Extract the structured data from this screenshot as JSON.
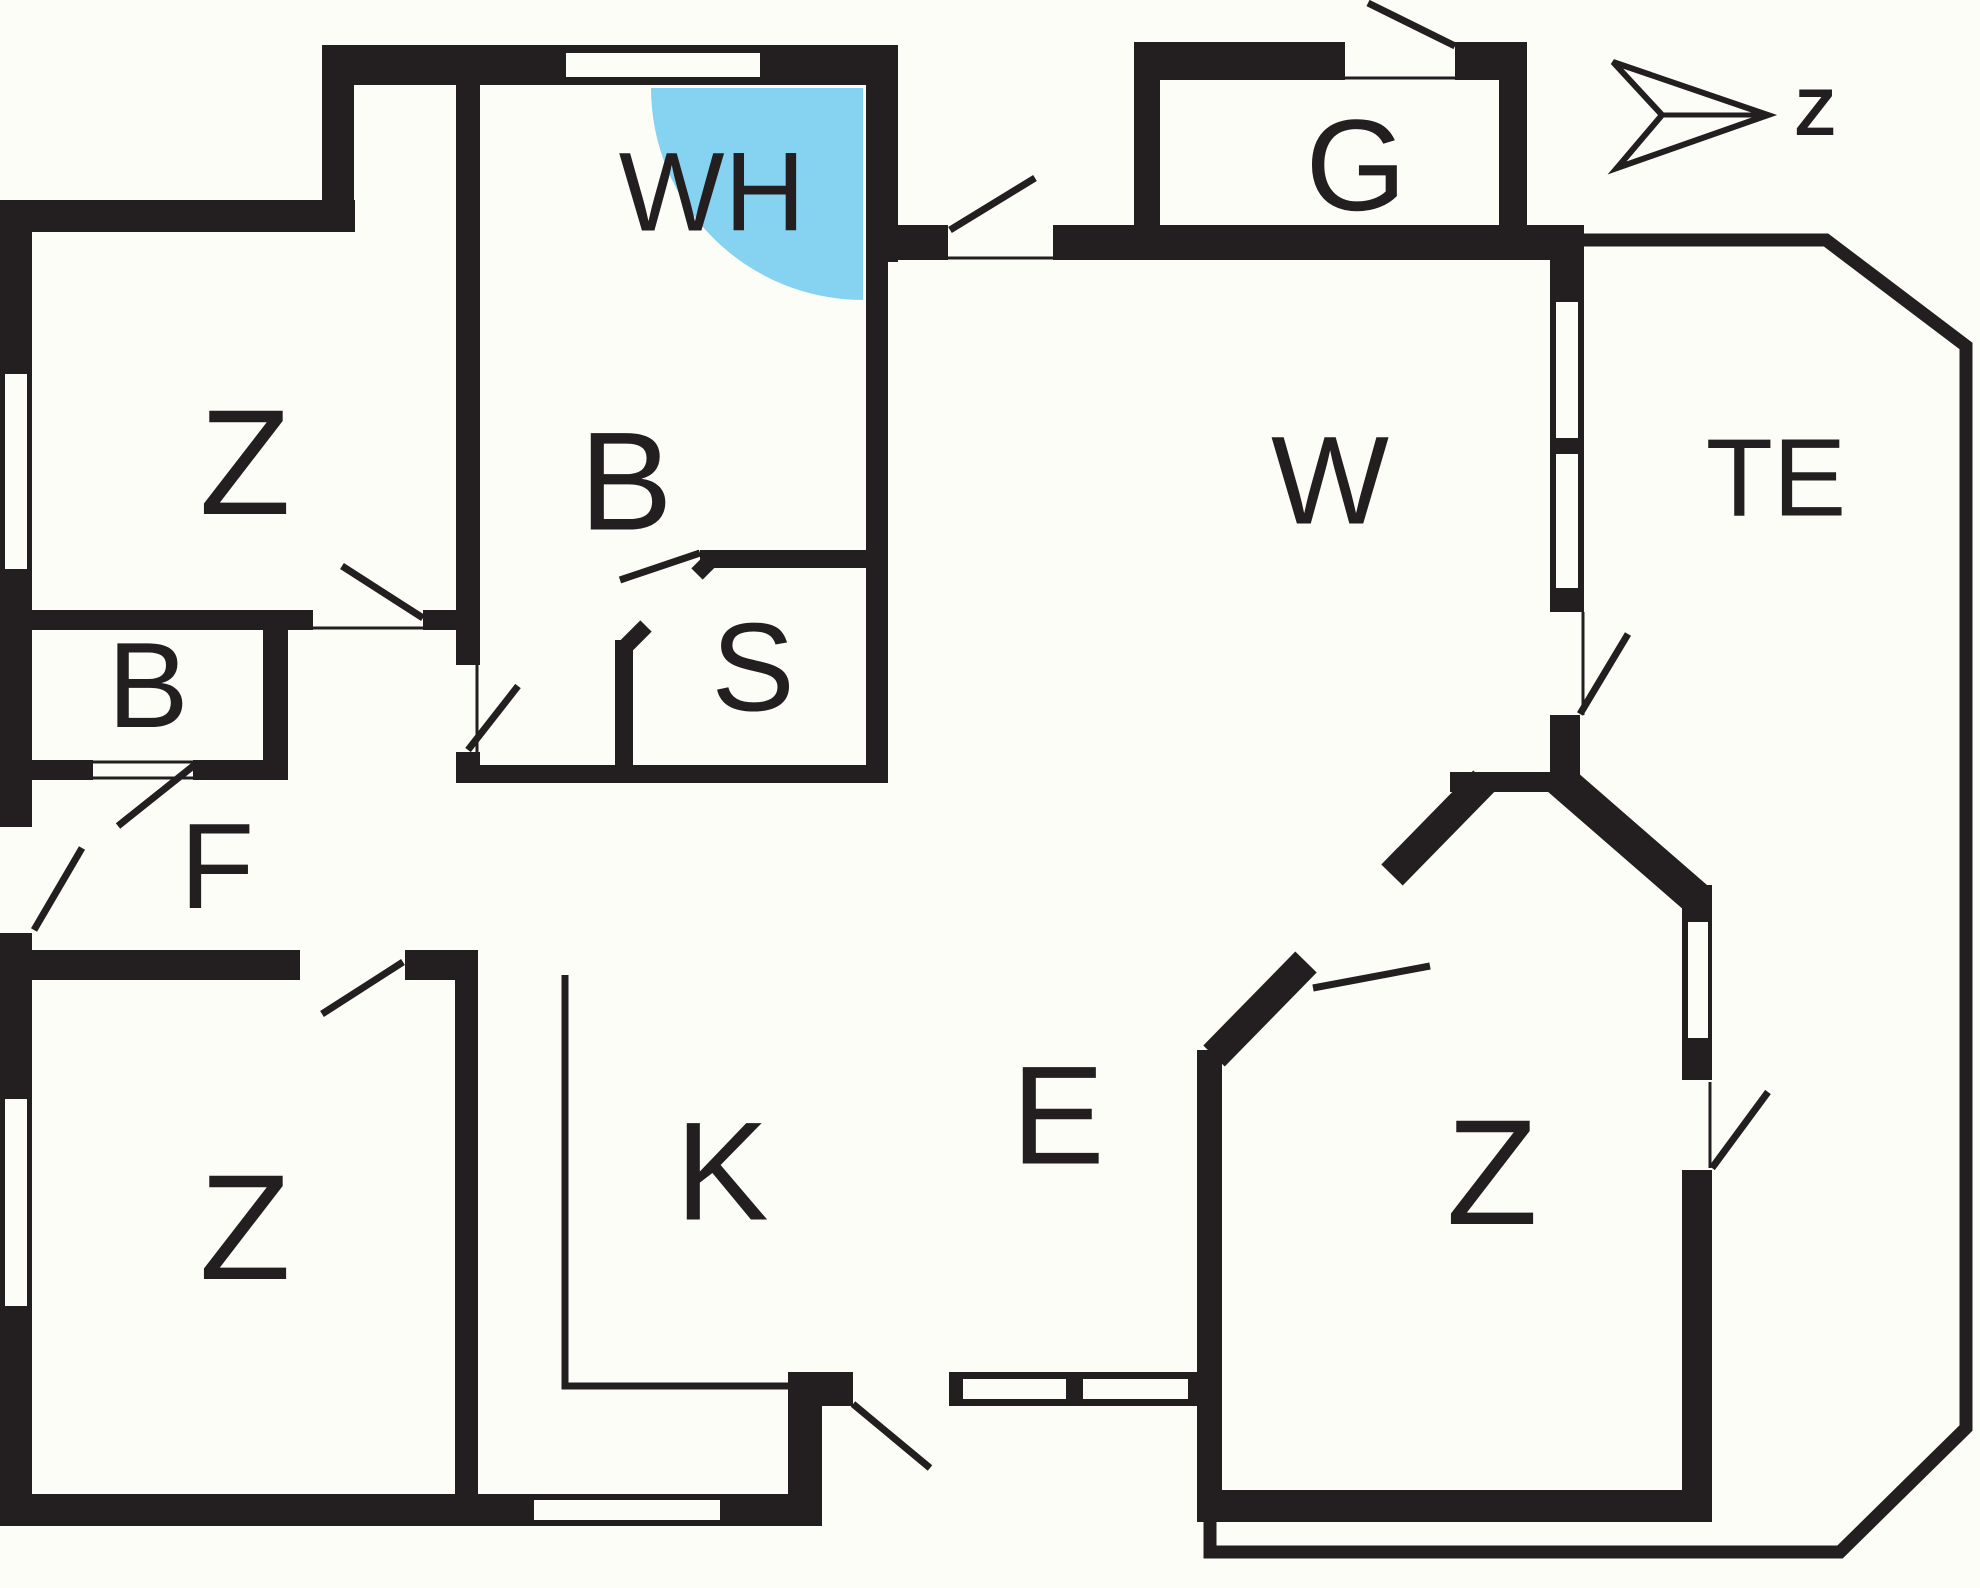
{
  "colors": {
    "wall": "#231F20",
    "paper": "#FDFDF7",
    "shower": "#85D3F0"
  },
  "rooms": [
    {
      "id": "bedroom-northwest",
      "label": "Z"
    },
    {
      "id": "bathroom",
      "label": "B"
    },
    {
      "id": "shower-corner",
      "label": "WH"
    },
    {
      "id": "sauna",
      "label": "S"
    },
    {
      "id": "wc",
      "label": "B"
    },
    {
      "id": "hallway",
      "label": "F"
    },
    {
      "id": "bedroom-southwest",
      "label": "Z"
    },
    {
      "id": "kitchen",
      "label": "K"
    },
    {
      "id": "dining",
      "label": "E"
    },
    {
      "id": "living-room",
      "label": "W"
    },
    {
      "id": "garage",
      "label": "G"
    },
    {
      "id": "bedroom-southeast",
      "label": "Z"
    },
    {
      "id": "terrace",
      "label": "TE"
    }
  ],
  "compass": {
    "label": "Z"
  }
}
